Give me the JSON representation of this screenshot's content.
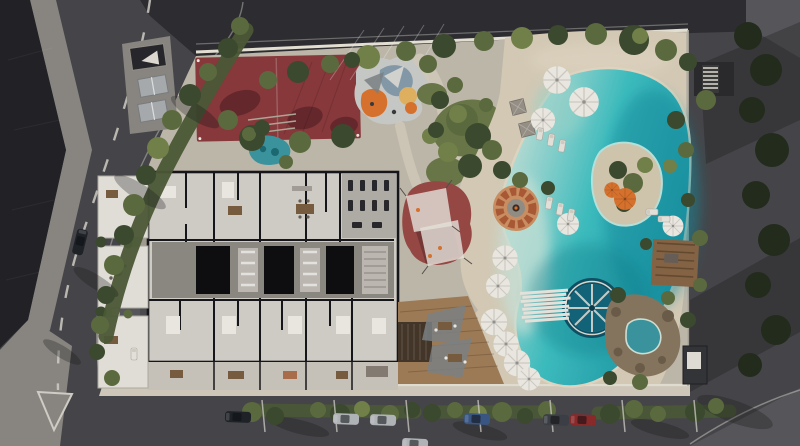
{
  "meta": {
    "title": "Aerial 3D render — residential site plan with lagoon pool",
    "render_type": "architectural-top-view",
    "width_px": 800,
    "height_px": 446
  },
  "scene": {
    "areas": [
      "perimeter-streets",
      "adjacent-rooftop",
      "street-parking-with-cars",
      "multi-sport-red-court",
      "table-plaza",
      "children-playground",
      "shade-sail-play-area",
      "fire-pit-lounge",
      "residential-floor-plan",
      "ground-floor-patios",
      "landscaped-garden",
      "sandy-beach",
      "lagoon-pool",
      "pool-island",
      "water-wheel-feature",
      "plank-bridge",
      "rock-grotto-spa",
      "wooden-deck-terrace",
      "pergolas",
      "umbrellas-and-loungers",
      "perimeter-wall",
      "driveway-entry",
      "traffic-island",
      "ornamental-pond"
    ]
  },
  "colors": {
    "asphalt": "#48484c",
    "asphaltLight": "#5a5a5e",
    "roadTop": "#2e2e33",
    "roofTile": "#232328",
    "paver": "#8f8c86",
    "concrete": "#c6bfb1",
    "sidewalk": "#d8d1c2",
    "sand": "#ddd2bd",
    "sandLight": "#e8dec9",
    "wallWhite": "#eee9dd",
    "lineWhite": "#d9d6ce",
    "hedge": "#4e5c38",
    "tree": "#5f6f41",
    "treeDark": "#3e4c30",
    "treeLight": "#76854c",
    "treeBlack": "#242d1e",
    "grass": "#6d7c4a",
    "courtRed": "#8d3a3d",
    "playRed": "#9c4a47",
    "padGray": "#cfd1cf",
    "playOrange": "#e0762f",
    "playYellow": "#e9b863",
    "playBlue": "#89a0af",
    "poolBeach": "#cfeae0",
    "poolMid": "#3fc4c6",
    "poolDeep": "#1592a4",
    "poolEdge": "#bfeae3",
    "islandSand": "#d9cdb4",
    "wheelTeal": "#14687e",
    "plank": "#efece4",
    "rock": "#8b7a61",
    "rockDark": "#6e5f4b",
    "spaBlue": "#3d9aa4",
    "wood": "#a5805a",
    "woodDark": "#46382b",
    "pergola": "#8a6847",
    "fireRing": "#b05c36",
    "fireInner": "#d29465",
    "umbrella": "#f5f2ea",
    "cabanaGray": "#9b958b",
    "bldWall": "#17171b",
    "bldFloor": "#d9d5ce",
    "bldFloorDark": "#c4c0b9",
    "corridor": "#918d86",
    "core": "#0e0e11",
    "gymFloor": "#b7b3ac",
    "patio": "#ebe8e2",
    "terrace": "#cfcac1",
    "furniture": "#6b625a",
    "furnWood": "#7d5f41",
    "carDark": "#20242a",
    "carSilver": "#b9bcbf",
    "carBlue": "#3c5a88",
    "carRed": "#8f2b2c",
    "carGray": "#3e4248"
  }
}
